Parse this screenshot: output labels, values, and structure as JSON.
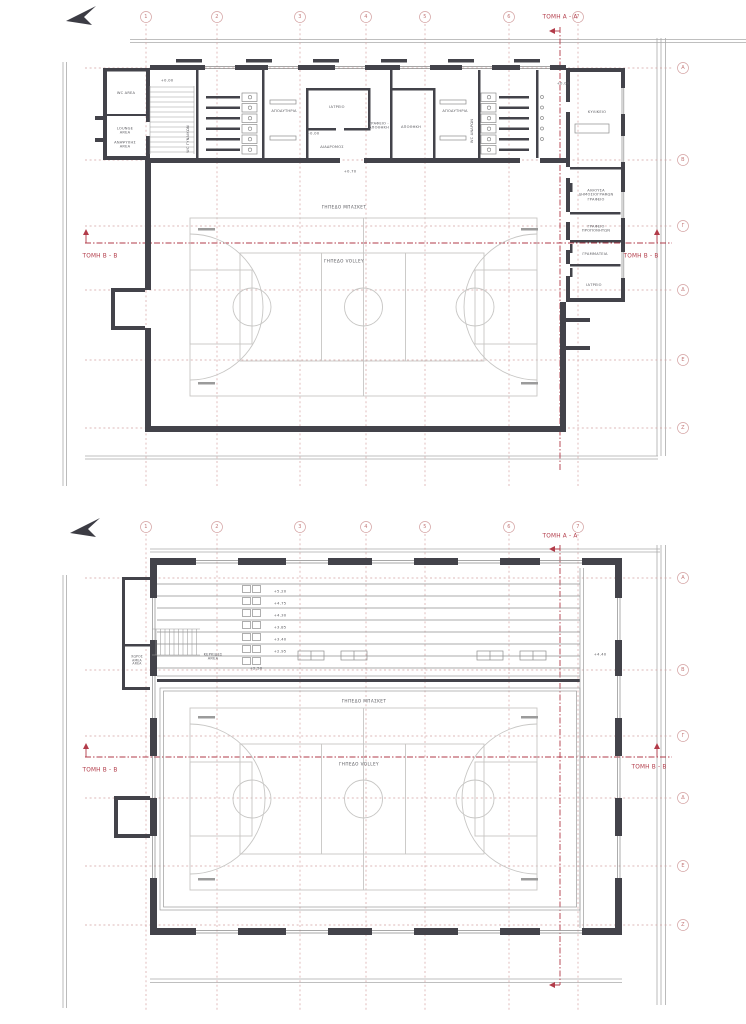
{
  "colors": {
    "wall": "#43434a",
    "site_line": "#ababab",
    "grid_line": "#d4a3a3",
    "section_line": "#b23b49",
    "court_line": "#c7c6c4",
    "label_text": "#5a5a5f"
  },
  "icons": {
    "north_arrow": "north-arrow-icon"
  },
  "plan1": {
    "annotations": [
      {
        "t": "1",
        "x": 146,
        "y": 17,
        "c": "bubble"
      },
      {
        "t": "2",
        "x": 217,
        "y": 17,
        "c": "bubble"
      },
      {
        "t": "3",
        "x": 300,
        "y": 17,
        "c": "bubble"
      },
      {
        "t": "4",
        "x": 366,
        "y": 17,
        "c": "bubble"
      },
      {
        "t": "5",
        "x": 425,
        "y": 17,
        "c": "bubble"
      },
      {
        "t": "6",
        "x": 509,
        "y": 17,
        "c": "bubble"
      },
      {
        "t": "7",
        "x": 578,
        "y": 17,
        "c": "bubble"
      },
      {
        "t": "Α",
        "x": 683,
        "y": 68,
        "c": "bubble"
      },
      {
        "t": "Β",
        "x": 683,
        "y": 160,
        "c": "bubble"
      },
      {
        "t": "Γ",
        "x": 683,
        "y": 226,
        "c": "bubble"
      },
      {
        "t": "Δ",
        "x": 683,
        "y": 290,
        "c": "bubble"
      },
      {
        "t": "Ε",
        "x": 683,
        "y": 360,
        "c": "bubble"
      },
      {
        "t": "Ζ",
        "x": 683,
        "y": 428,
        "c": "bubble"
      },
      {
        "t": "ΤΟΜΗ Α - Α",
        "x": 560,
        "y": 18,
        "c": "sec"
      },
      {
        "t": "ΤΟΜΗ Β - Β",
        "x": 100,
        "y": 257,
        "c": "sec"
      },
      {
        "t": "ΤΟΜΗ Β - Β",
        "x": 641,
        "y": 257,
        "c": "sec"
      },
      {
        "t": "WC AREA",
        "x": 126,
        "y": 93,
        "c": "room"
      },
      {
        "t": "LOUNGE\nAREA",
        "x": 125,
        "y": 131,
        "c": "room"
      },
      {
        "t": "ΑΝΑΨΥΧΗΣ\nAREA",
        "x": 125,
        "y": 145,
        "c": "room"
      },
      {
        "t": "+0.00",
        "x": 167,
        "y": 81,
        "c": "level"
      },
      {
        "t": "WC ΓΥΝΑΙΚΩΝ",
        "x": 188,
        "y": 139,
        "c": "vroom"
      },
      {
        "t": "ΑΠΟΔΥΤΗΡΙΑ",
        "x": 284,
        "y": 111,
        "c": "room"
      },
      {
        "t": "+0.00",
        "x": 313,
        "y": 134,
        "c": "level"
      },
      {
        "t": "ΙΑΤΡΕΙΟ",
        "x": 337,
        "y": 107,
        "c": "room"
      },
      {
        "t": "ΔΙΑΔΡΟΜΟΣ",
        "x": 332,
        "y": 147,
        "c": "room"
      },
      {
        "t": "ΓΡΑΦΕΙΟ -\nΑΠΟΘΗΚΗ",
        "x": 379,
        "y": 126,
        "c": "room"
      },
      {
        "t": "ΑΠΟΘΗΚΗ",
        "x": 411,
        "y": 127,
        "c": "room"
      },
      {
        "t": "ΑΠΟΔΥΤΗΡΙΑ",
        "x": 455,
        "y": 111,
        "c": "room"
      },
      {
        "t": "WC ΑΝΔΡΩΝ",
        "x": 472,
        "y": 131,
        "c": "vroom"
      },
      {
        "t": "+0.70",
        "x": 350,
        "y": 172,
        "c": "level"
      },
      {
        "t": "+0.00",
        "x": 563,
        "y": 84,
        "c": "level"
      },
      {
        "t": "ΚΥΛΙΚΕΙΟ",
        "x": 597,
        "y": 112,
        "c": "room"
      },
      {
        "t": "ΑΙΘΟΥΣΑ\nΔΗΜΟΣΙΟΓΡΑΦΩΝ\nΓΡΑΦΕΙΟ",
        "x": 596,
        "y": 195,
        "c": "room"
      },
      {
        "t": "ΓΡΑΦΕΙΟ\nΠΡΟΠΟΝΗΤΩΝ",
        "x": 596,
        "y": 229,
        "c": "room"
      },
      {
        "t": "ΓΡΑΜΜΑΤΕΙΑ",
        "x": 595,
        "y": 254,
        "c": "room"
      },
      {
        "t": "ΙΑΤΡΕΙΟ",
        "x": 594,
        "y": 285,
        "c": "room"
      },
      {
        "t": "ΓΗΠΕΔΟ ΜΠΑΣΚΕΤ",
        "x": 344,
        "y": 207,
        "c": "court"
      },
      {
        "t": "ΓΗΠΕΔΟ VOLLEY",
        "x": 344,
        "y": 261,
        "c": "court"
      }
    ]
  },
  "plan2": {
    "annotations": [
      {
        "t": "1",
        "x": 146,
        "y": 527,
        "c": "bubble"
      },
      {
        "t": "2",
        "x": 217,
        "y": 527,
        "c": "bubble"
      },
      {
        "t": "3",
        "x": 300,
        "y": 527,
        "c": "bubble"
      },
      {
        "t": "4",
        "x": 366,
        "y": 527,
        "c": "bubble"
      },
      {
        "t": "5",
        "x": 425,
        "y": 527,
        "c": "bubble"
      },
      {
        "t": "6",
        "x": 509,
        "y": 527,
        "c": "bubble"
      },
      {
        "t": "7",
        "x": 578,
        "y": 527,
        "c": "bubble"
      },
      {
        "t": "Α",
        "x": 683,
        "y": 578,
        "c": "bubble"
      },
      {
        "t": "Β",
        "x": 683,
        "y": 670,
        "c": "bubble"
      },
      {
        "t": "Γ",
        "x": 683,
        "y": 736,
        "c": "bubble"
      },
      {
        "t": "Δ",
        "x": 683,
        "y": 798,
        "c": "bubble"
      },
      {
        "t": "Ε",
        "x": 683,
        "y": 866,
        "c": "bubble"
      },
      {
        "t": "Ζ",
        "x": 683,
        "y": 925,
        "c": "bubble"
      },
      {
        "t": "ΤΟΜΗ Α - Α",
        "x": 560,
        "y": 537,
        "c": "sec"
      },
      {
        "t": "ΤΟΜΗ Β - Β",
        "x": 100,
        "y": 771,
        "c": "sec"
      },
      {
        "t": "ΤΟΜΗ Β - Β",
        "x": 649,
        "y": 768,
        "c": "sec"
      },
      {
        "t": "ΧΩΡΟΣ\nΑΜΕΑ\nAREA",
        "x": 137,
        "y": 661,
        "c": "tiny"
      },
      {
        "t": "ΚΕΡΚΙΔΕΣ\nAREA",
        "x": 213,
        "y": 657,
        "c": "room"
      },
      {
        "t": "+5.20",
        "x": 280,
        "y": 592,
        "c": "level"
      },
      {
        "t": "+4.75",
        "x": 280,
        "y": 604,
        "c": "level"
      },
      {
        "t": "+4.30",
        "x": 280,
        "y": 616,
        "c": "level"
      },
      {
        "t": "+3.85",
        "x": 280,
        "y": 628,
        "c": "level"
      },
      {
        "t": "+3.40",
        "x": 280,
        "y": 640,
        "c": "level"
      },
      {
        "t": "+2.95",
        "x": 280,
        "y": 652,
        "c": "level"
      },
      {
        "t": "+2.50",
        "x": 256,
        "y": 669,
        "c": "level"
      },
      {
        "t": "+4.40",
        "x": 600,
        "y": 655,
        "c": "level"
      },
      {
        "t": "ΓΗΠΕΔΟ ΜΠΑΣΚΕΤ",
        "x": 364,
        "y": 701,
        "c": "court"
      },
      {
        "t": "ΓΗΠΕΔΟ VOLLEY",
        "x": 359,
        "y": 764,
        "c": "court"
      }
    ]
  }
}
